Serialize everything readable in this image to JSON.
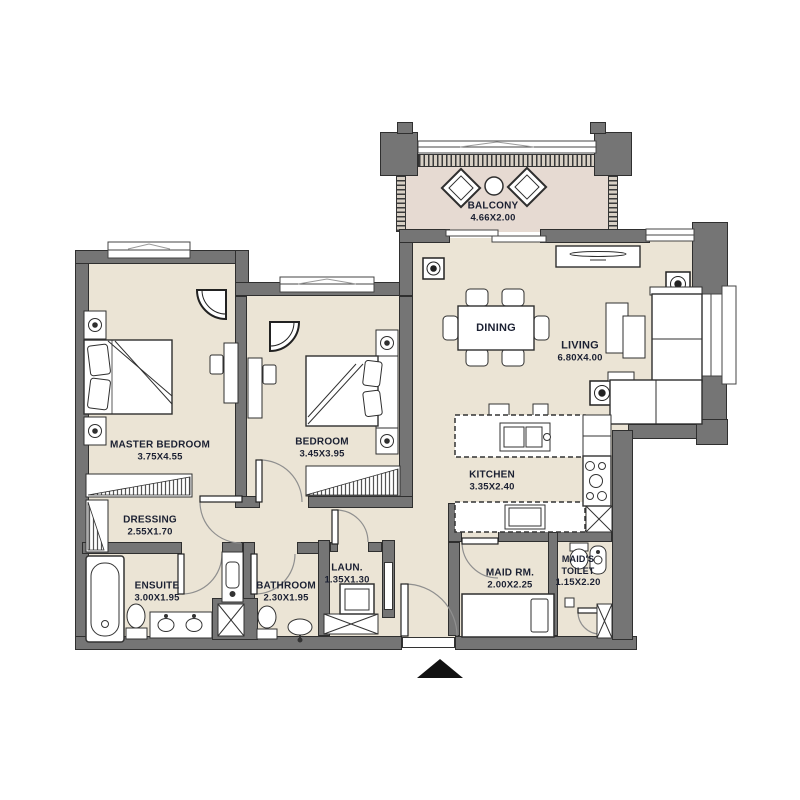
{
  "title": "Apartment floor plan",
  "colors": {
    "wall": "#757575",
    "wall_border": "#2f2f2f",
    "floor": "#ebe4d5",
    "balcony_floor": "#e6dad2",
    "label": "#1b2032",
    "line": "#2f2f2f"
  },
  "rooms": {
    "balcony": {
      "name": "BALCONY",
      "dims": "4.66X2.00"
    },
    "dining": {
      "name": "DINING"
    },
    "living": {
      "name": "LIVING",
      "dims": "6.80X4.00"
    },
    "master_bedroom": {
      "name": "MASTER BEDROOM",
      "dims": "3.75X4.55"
    },
    "bedroom": {
      "name": "BEDROOM",
      "dims": "3.45X3.95"
    },
    "dressing": {
      "name": "DRESSING",
      "dims": "2.55X1.70"
    },
    "ensuite": {
      "name": "ENSUITE",
      "dims": "3.00X1.95"
    },
    "bathroom": {
      "name": "BATHROOM",
      "dims": "2.30X1.95"
    },
    "laundry": {
      "name": "LAUN.",
      "dims": "1.35X1.30"
    },
    "kitchen": {
      "name": "KITCHEN",
      "dims": "3.35X2.40"
    },
    "maid_room": {
      "name": "MAID RM.",
      "dims": "2.00X2.25"
    },
    "maids_toilet": {
      "name": "MAID'S TOILET",
      "dims": "1.15X2.20"
    }
  }
}
